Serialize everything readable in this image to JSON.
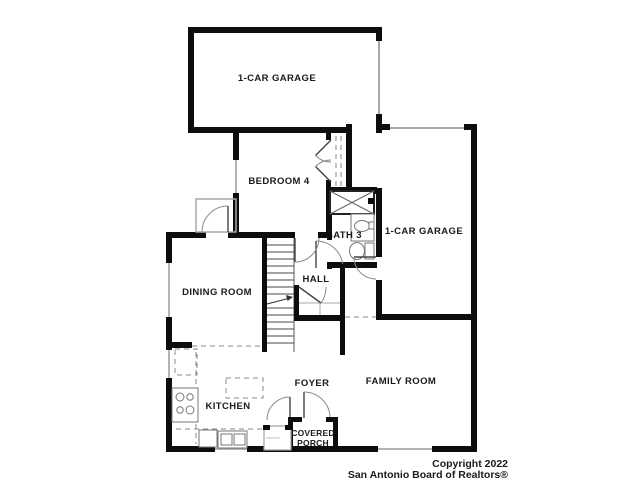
{
  "rooms": {
    "garage_top": "1-CAR GARAGE",
    "garage_right": "1-CAR GARAGE",
    "bedroom4": "BEDROOM 4",
    "bath3": "BATH 3",
    "dining": "DINING ROOM",
    "hall": "HALL",
    "kitchen": "KITCHEN",
    "foyer": "FOYER",
    "family": "FAMILY ROOM",
    "porch": {
      "line1": "COVERED",
      "line2": "PORCH"
    }
  },
  "copyright": {
    "line1": "Copyright 2022",
    "line2": "San Antonio Board of Realtors®"
  },
  "colors": {
    "wall": "#0d0d0d",
    "garage_door_line": "#a8a8a8",
    "label": "#1a1a1a",
    "background": "#ffffff"
  }
}
